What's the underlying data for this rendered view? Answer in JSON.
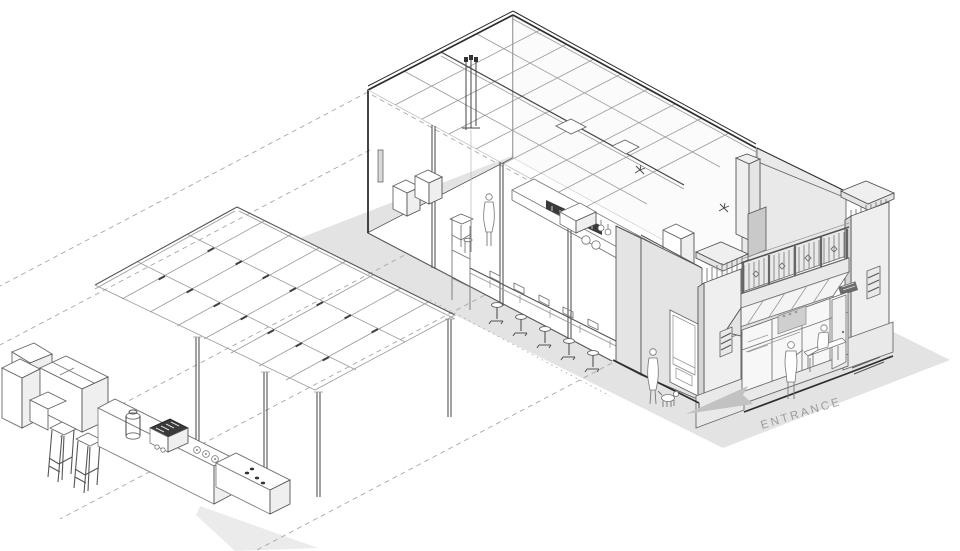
{
  "scene": {
    "title": "Axonometric cutaway diagram of a corner cafe with pergola and outdoor coffee bar"
  },
  "labels": {
    "entrance": "ENTRANCE"
  },
  "colors": {
    "background": "#ffffff",
    "ground": "#e3e3e3",
    "ground_shadow": "#ebebeb",
    "facade_light": "#efefef",
    "facade_mid": "#e4e4e4",
    "facade_dark": "#d6d6d6",
    "chimney": "#c9c9c9",
    "awning_top": "#f4f4f4",
    "awning_front": "#e2e2e2",
    "glass": "#f7f7f7",
    "menu_board": "#3a3a3a",
    "line_dark": "#2e2e2e",
    "line_mid": "#666666",
    "line_light": "#999999",
    "dash_line": "#a8a8a8",
    "entrance_arrow": "#c2c2c2",
    "entrance_text": "#9b9b9b"
  }
}
